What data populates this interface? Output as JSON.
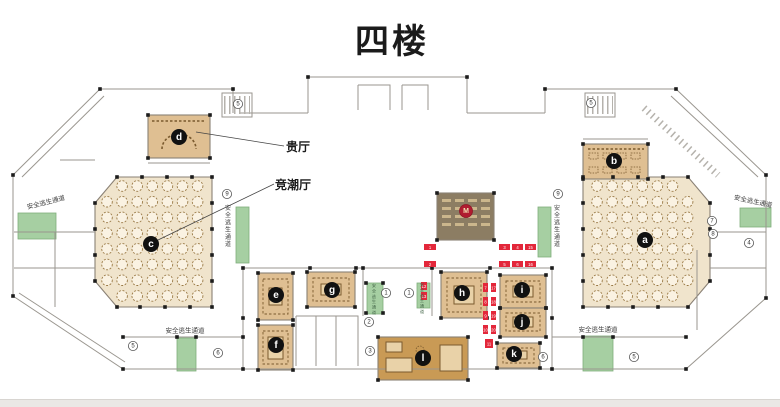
{
  "title": "四楼",
  "labels": {
    "vip_hall": "贵厅",
    "main_hall": "竞潮厅",
    "escape": "安全逃生通道"
  },
  "colors": {
    "hallLight": "#f0e4cc",
    "roomTan": "#dfbf92",
    "roomDark": "#c99a55",
    "taupe": "#8c7d63",
    "green": "#a6cfa2",
    "greenEdge": "#7fae7c",
    "red": "#e3273a",
    "mRed": "#b01c30",
    "wall": "#9a968f",
    "furn": "#7a5a2e",
    "black": "#1c1c1c",
    "tableFill": "#faf2e2",
    "tableEdge": "#9a7a46",
    "mRowFill": "#cbb68c"
  },
  "rooms": [
    {
      "id": "hall-c",
      "poly": [
        [
          117,
          177
        ],
        [
          212,
          177
        ],
        [
          212,
          307
        ],
        [
          117,
          307
        ],
        [
          95,
          281
        ],
        [
          95,
          203
        ]
      ],
      "fill": "hallLight"
    },
    {
      "id": "hall-a",
      "poly": [
        [
          583,
          177
        ],
        [
          688,
          177
        ],
        [
          710,
          203
        ],
        [
          710,
          281
        ],
        [
          688,
          307
        ],
        [
          583,
          307
        ]
      ],
      "fill": "hallLight"
    },
    {
      "id": "room-d",
      "rect": [
        148,
        115,
        62,
        43
      ],
      "fill": "roomTan"
    },
    {
      "id": "room-b",
      "rect": [
        583,
        144,
        65,
        35
      ],
      "fill": "roomTan"
    },
    {
      "id": "room-m",
      "rect": [
        437,
        193,
        57,
        47
      ],
      "fill": "taupe"
    },
    {
      "id": "room-e",
      "rect": [
        258,
        273,
        35,
        47
      ],
      "fill": "roomTan"
    },
    {
      "id": "room-f",
      "rect": [
        258,
        325,
        35,
        45
      ],
      "fill": "roomTan"
    },
    {
      "id": "room-g",
      "rect": [
        307,
        272,
        48,
        35
      ],
      "fill": "roomTan"
    },
    {
      "id": "room-h",
      "rect": [
        441,
        272,
        46,
        46
      ],
      "fill": "roomTan"
    },
    {
      "id": "room-i",
      "rect": [
        500,
        275,
        46,
        33
      ],
      "fill": "roomTan"
    },
    {
      "id": "room-j",
      "rect": [
        500,
        308,
        46,
        29
      ],
      "fill": "roomTan"
    },
    {
      "id": "room-k",
      "rect": [
        497,
        343,
        43,
        25
      ],
      "fill": "roomTan"
    },
    {
      "id": "room-l",
      "rect": [
        378,
        337,
        90,
        43
      ],
      "fill": "roomDark"
    }
  ],
  "green_zones": [
    {
      "rect": [
        18,
        213,
        38,
        26
      ]
    },
    {
      "rect": [
        236,
        207,
        13,
        56
      ]
    },
    {
      "rect": [
        538,
        207,
        13,
        50
      ]
    },
    {
      "rect": [
        367,
        283,
        16,
        31
      ]
    },
    {
      "rect": [
        417,
        283,
        13,
        25
      ]
    },
    {
      "rect": [
        177,
        338,
        19,
        33
      ]
    },
    {
      "rect": [
        583,
        336,
        30,
        35
      ]
    },
    {
      "rect": [
        740,
        208,
        31,
        19
      ]
    }
  ],
  "escape_labels": [
    {
      "x": 46,
      "y": 203,
      "rot": -14,
      "fs": 6.5
    },
    {
      "x": 228,
      "y": 210,
      "vert": true,
      "fs": 6
    },
    {
      "x": 557,
      "y": 210,
      "vert": true,
      "fs": 6
    },
    {
      "x": 185,
      "y": 331,
      "rot": 0,
      "fs": 6.5
    },
    {
      "x": 598,
      "y": 330,
      "rot": 0,
      "fs": 6.5
    },
    {
      "x": 753,
      "y": 202,
      "rot": 12,
      "fs": 6.5
    },
    {
      "x": 374,
      "y": 287,
      "vert": true,
      "fs": 4.2,
      "color": "#46684a"
    },
    {
      "x": 422,
      "y": 286,
      "vert": true,
      "fs": 4.2,
      "color": "#46684a"
    }
  ],
  "letter_markers": [
    {
      "ch": "a",
      "x": 645,
      "y": 240
    },
    {
      "ch": "b",
      "x": 614,
      "y": 161
    },
    {
      "ch": "c",
      "x": 151,
      "y": 244
    },
    {
      "ch": "d",
      "x": 179,
      "y": 137
    },
    {
      "ch": "e",
      "x": 276,
      "y": 295
    },
    {
      "ch": "f",
      "x": 276,
      "y": 345
    },
    {
      "ch": "g",
      "x": 332,
      "y": 290
    },
    {
      "ch": "h",
      "x": 462,
      "y": 293
    },
    {
      "ch": "i",
      "x": 522,
      "y": 290
    },
    {
      "ch": "j",
      "x": 522,
      "y": 322
    },
    {
      "ch": "k",
      "x": 514,
      "y": 354
    },
    {
      "ch": "l",
      "x": 423,
      "y": 358
    }
  ],
  "m_marker": {
    "ch": "M",
    "x": 466,
    "y": 211
  },
  "circled_numbers": [
    {
      "n": "5",
      "x": 238,
      "y": 104
    },
    {
      "n": "5",
      "x": 591,
      "y": 103
    },
    {
      "n": "9",
      "x": 227,
      "y": 194
    },
    {
      "n": "9",
      "x": 558,
      "y": 194
    },
    {
      "n": "7",
      "x": 712,
      "y": 221
    },
    {
      "n": "8",
      "x": 713,
      "y": 234
    },
    {
      "n": "4",
      "x": 749,
      "y": 243
    },
    {
      "n": "1",
      "x": 386,
      "y": 293
    },
    {
      "n": "1",
      "x": 409,
      "y": 293
    },
    {
      "n": "2",
      "x": 369,
      "y": 322
    },
    {
      "n": "3",
      "x": 370,
      "y": 351
    },
    {
      "n": "5",
      "x": 133,
      "y": 346
    },
    {
      "n": "6",
      "x": 218,
      "y": 353
    },
    {
      "n": "6",
      "x": 543,
      "y": 357
    },
    {
      "n": "5",
      "x": 634,
      "y": 357
    }
  ],
  "red_markers": [
    {
      "n": "1",
      "x": 424,
      "y": 244,
      "w": 12,
      "h": 6
    },
    {
      "n": "2",
      "x": 424,
      "y": 261,
      "w": 12,
      "h": 6
    },
    {
      "n": "3",
      "x": 499,
      "y": 244,
      "w": 11,
      "h": 6
    },
    {
      "n": "4",
      "x": 512,
      "y": 244,
      "w": 11,
      "h": 6
    },
    {
      "n": "15",
      "x": 525,
      "y": 244,
      "w": 11,
      "h": 6
    },
    {
      "n": "5",
      "x": 499,
      "y": 261,
      "w": 11,
      "h": 6
    },
    {
      "n": "6",
      "x": 512,
      "y": 261,
      "w": 11,
      "h": 6
    },
    {
      "n": "16",
      "x": 525,
      "y": 261,
      "w": 11,
      "h": 6
    },
    {
      "n": "7",
      "x": 483,
      "y": 283,
      "w": 5,
      "h": 9
    },
    {
      "n": "17",
      "x": 491,
      "y": 283,
      "w": 5,
      "h": 9
    },
    {
      "n": "8",
      "x": 483,
      "y": 297,
      "w": 5,
      "h": 9
    },
    {
      "n": "18",
      "x": 491,
      "y": 297,
      "w": 5,
      "h": 9
    },
    {
      "n": "9",
      "x": 483,
      "y": 311,
      "w": 5,
      "h": 9
    },
    {
      "n": "19",
      "x": 491,
      "y": 311,
      "w": 5,
      "h": 9
    },
    {
      "n": "10",
      "x": 483,
      "y": 325,
      "w": 5,
      "h": 9
    },
    {
      "n": "20",
      "x": 491,
      "y": 325,
      "w": 5,
      "h": 9
    },
    {
      "n": "11",
      "x": 485,
      "y": 339,
      "w": 8,
      "h": 9
    },
    {
      "n": "12",
      "x": 421,
      "y": 282,
      "w": 6,
      "h": 8
    },
    {
      "n": "13",
      "x": 421,
      "y": 292,
      "w": 6,
      "h": 8
    }
  ],
  "table_grids": [
    {
      "x0": 107,
      "y0": 186,
      "cols": 7,
      "rows": 8,
      "dx": 15.1,
      "dy": 15.7,
      "r": 5.3,
      "skip": [
        [
          0,
          0
        ],
        [
          0,
          7
        ]
      ]
    },
    {
      "x0": 597,
      "y0": 186,
      "cols": 7,
      "rows": 8,
      "dx": 15.1,
      "dy": 15.7,
      "r": 5.3,
      "skip": [
        [
          6,
          0
        ],
        [
          6,
          7
        ]
      ]
    }
  ],
  "m_room_rows": {
    "cols": [
      442,
      455,
      468,
      481
    ],
    "rows": [
      199,
      207,
      215,
      223
    ],
    "w": 9,
    "h": 3
  },
  "furniture": {
    "rings": [
      [
        263,
        279,
        25,
        35
      ],
      [
        263,
        331,
        25,
        33
      ],
      [
        313,
        278,
        36,
        23
      ],
      [
        447,
        278,
        34,
        34
      ],
      [
        506,
        281,
        34,
        21
      ],
      [
        506,
        313,
        34,
        18
      ],
      [
        503,
        348,
        31,
        15
      ]
    ],
    "tables": [
      [
        269,
        288,
        13,
        17
      ],
      [
        268,
        337,
        15,
        22
      ],
      [
        321,
        284,
        20,
        11
      ],
      [
        454,
        286,
        20,
        18
      ],
      [
        513,
        286,
        20,
        11
      ],
      [
        513,
        317,
        20,
        10
      ],
      [
        510,
        351,
        17,
        8
      ],
      [
        440,
        345,
        22,
        26
      ],
      [
        386,
        358,
        26,
        14
      ],
      [
        386,
        342,
        16,
        10
      ]
    ],
    "chair_rects": [
      [
        589,
        153
      ],
      [
        603,
        153
      ],
      [
        617,
        153
      ],
      [
        631,
        153
      ],
      [
        589,
        167
      ],
      [
        603,
        167
      ],
      [
        617,
        167
      ],
      [
        631,
        167
      ]
    ],
    "dash_lines": [
      [
        152,
        121,
        206,
        121
      ],
      [
        588,
        149,
        644,
        149
      ]
    ],
    "arcs": [
      "M162,149 A17,15 0 1 1 196,149"
    ],
    "dash_circles": [
      [
        420,
        350,
        4
      ]
    ]
  },
  "walls": [
    "M100,89 L233,89",
    "M100,89 L13,175 L13,296 L123,369 L686,369 L766,298 L766,175 L676,89 L545,89",
    "M308,77 L467,77",
    "M308,77 L308,113",
    "M467,77 L467,113",
    "M233,89 L233,113",
    "M545,89 L545,113",
    "M104,96 L22,177",
    "M19,293 L125,362",
    "M671,96 L758,177",
    "M243,268 L552,268",
    "M243,268 L243,369",
    "M552,268 L552,369",
    "M123,337 L243,337",
    "M552,337 L686,337",
    "M363,268 L363,316",
    "M432,268 L432,316",
    "M296,316 L358,316 L358,366",
    "M296,316 L296,366",
    "M316,316 L316,366",
    "M336,316 L336,366",
    "M358,85 L390,85 L390,110 M358,85 L358,110",
    "M402,85 L428,85 L428,110 M402,85 L402,110",
    "M14,232 L95,232",
    "M14,268 L95,268",
    "M55,232 L55,307",
    "M710,232 L766,232",
    "M710,268 L766,268",
    "M697,250 L697,330",
    "M60,160 L95,160",
    "M148,163 L210,163",
    "M583,139 L648,139",
    "M222,93 L252,93 L252,117 L222,117 Z",
    "M585,93 L615,93 L615,117 L585,117 Z",
    "M240,113 L308,113",
    "M467,113 L545,113"
  ],
  "stair_bands": [
    {
      "x1": 644,
      "y1": 108,
      "x2": 718,
      "y2": 175,
      "w": 7,
      "dash": "1.5,4"
    },
    {
      "x1": 224,
      "y1": 105,
      "x2": 250,
      "y2": 105,
      "w": 18,
      "dash": "1.5,3.5"
    },
    {
      "x1": 587,
      "y1": 105,
      "x2": 613,
      "y2": 105,
      "w": 18,
      "dash": "1.5,3.5"
    }
  ],
  "leaders": [
    [
      196,
      132,
      284,
      146
    ],
    [
      158,
      240,
      274,
      184
    ]
  ],
  "columns_extra": [
    [
      100,
      89
    ],
    [
      233,
      89
    ],
    [
      13,
      175
    ],
    [
      13,
      296
    ],
    [
      123,
      369
    ],
    [
      686,
      369
    ],
    [
      766,
      298
    ],
    [
      766,
      175
    ],
    [
      676,
      89
    ],
    [
      545,
      89
    ],
    [
      308,
      77
    ],
    [
      467,
      77
    ],
    [
      243,
      268
    ],
    [
      310,
      268
    ],
    [
      356,
      268
    ],
    [
      363,
      268
    ],
    [
      432,
      268
    ],
    [
      490,
      268
    ],
    [
      552,
      268
    ],
    [
      243,
      318
    ],
    [
      552,
      318
    ],
    [
      243,
      369
    ],
    [
      552,
      369
    ],
    [
      123,
      337
    ],
    [
      177,
      337
    ],
    [
      196,
      337
    ],
    [
      243,
      337
    ],
    [
      583,
      337
    ],
    [
      613,
      337
    ],
    [
      686,
      337
    ],
    [
      366,
      283
    ],
    [
      383,
      283
    ],
    [
      366,
      313
    ],
    [
      383,
      313
    ]
  ],
  "columns_halls": [
    [
      117,
      177
    ],
    [
      142,
      177
    ],
    [
      167,
      177
    ],
    [
      192,
      177
    ],
    [
      212,
      177
    ],
    [
      212,
      203
    ],
    [
      212,
      229
    ],
    [
      212,
      255
    ],
    [
      212,
      281
    ],
    [
      212,
      307
    ],
    [
      190,
      307
    ],
    [
      165,
      307
    ],
    [
      140,
      307
    ],
    [
      117,
      307
    ],
    [
      95,
      281
    ],
    [
      95,
      255
    ],
    [
      95,
      229
    ],
    [
      95,
      203
    ],
    [
      688,
      177
    ],
    [
      663,
      177
    ],
    [
      638,
      177
    ],
    [
      613,
      177
    ],
    [
      583,
      177
    ],
    [
      583,
      203
    ],
    [
      583,
      229
    ],
    [
      583,
      255
    ],
    [
      583,
      281
    ],
    [
      583,
      307
    ],
    [
      608,
      307
    ],
    [
      633,
      307
    ],
    [
      658,
      307
    ],
    [
      688,
      307
    ],
    [
      710,
      281
    ],
    [
      710,
      255
    ],
    [
      710,
      229
    ],
    [
      710,
      203
    ]
  ]
}
